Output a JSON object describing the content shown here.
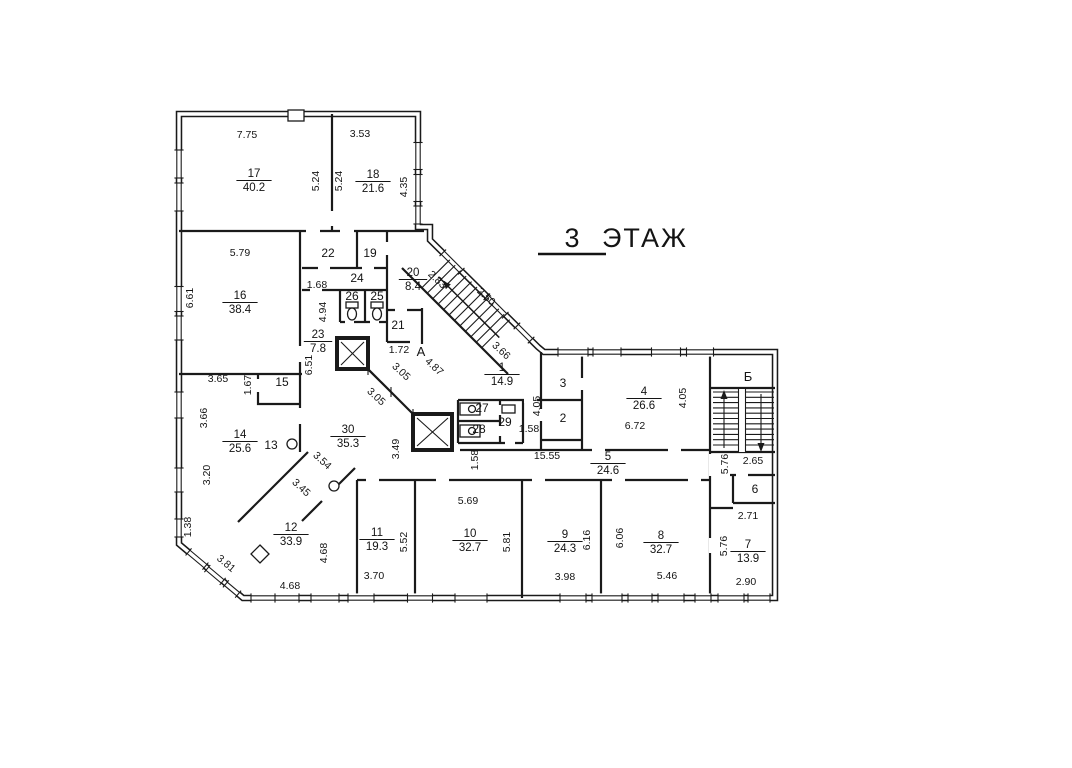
{
  "title": {
    "number": "3",
    "word": "ЭТАЖ"
  },
  "colors": {
    "ink": "#1a1a1a",
    "paper": "#ffffff"
  },
  "stairwells": [
    {
      "label": "А",
      "x": 421,
      "y": 356
    },
    {
      "label": "Б",
      "x": 748,
      "y": 381
    }
  ],
  "rooms": [
    {
      "number": "17",
      "area": "40.2",
      "x": 254,
      "y": 180
    },
    {
      "number": "18",
      "area": "21.6",
      "x": 373,
      "y": 181
    },
    {
      "number": "16",
      "area": "38.4",
      "x": 240,
      "y": 302
    },
    {
      "number": "20",
      "area": "8.4",
      "x": 413,
      "y": 279
    },
    {
      "number": "23",
      "area": "7.8",
      "x": 318,
      "y": 341
    },
    {
      "number": "1",
      "area": "14.9",
      "x": 502,
      "y": 374
    },
    {
      "number": "4",
      "area": "26.6",
      "x": 644,
      "y": 398
    },
    {
      "number": "14",
      "area": "25.6",
      "x": 240,
      "y": 441
    },
    {
      "number": "30",
      "area": "35.3",
      "x": 348,
      "y": 436
    },
    {
      "number": "5",
      "area": "24.6",
      "x": 608,
      "y": 463
    },
    {
      "number": "12",
      "area": "33.9",
      "x": 291,
      "y": 534
    },
    {
      "number": "11",
      "area": "19.3",
      "x": 377,
      "y": 539
    },
    {
      "number": "10",
      "area": "32.7",
      "x": 470,
      "y": 540
    },
    {
      "number": "9",
      "area": "24.3",
      "x": 565,
      "y": 541
    },
    {
      "number": "8",
      "area": "32.7",
      "x": 661,
      "y": 542
    },
    {
      "number": "7",
      "area": "13.9",
      "x": 748,
      "y": 551
    }
  ],
  "numbered_spaces": [
    {
      "label": "22",
      "x": 328,
      "y": 257
    },
    {
      "label": "19",
      "x": 370,
      "y": 257
    },
    {
      "label": "24",
      "x": 357,
      "y": 282
    },
    {
      "label": "26",
      "x": 352,
      "y": 300
    },
    {
      "label": "25",
      "x": 377,
      "y": 300
    },
    {
      "label": "21",
      "x": 398,
      "y": 329
    },
    {
      "label": "15",
      "x": 282,
      "y": 386
    },
    {
      "label": "13",
      "x": 271,
      "y": 449
    },
    {
      "label": "3",
      "x": 563,
      "y": 387
    },
    {
      "label": "2",
      "x": 563,
      "y": 422
    },
    {
      "label": "27",
      "x": 482,
      "y": 412
    },
    {
      "label": "28",
      "x": 479,
      "y": 433
    },
    {
      "label": "29",
      "x": 505,
      "y": 426
    },
    {
      "label": "6",
      "x": 755,
      "y": 493
    }
  ],
  "dimensions": [
    {
      "t": "7.75",
      "x": 247,
      "y": 138,
      "r": 0
    },
    {
      "t": "3.53",
      "x": 360,
      "y": 137,
      "r": 0
    },
    {
      "t": "5.24",
      "x": 319,
      "y": 181,
      "r": -90
    },
    {
      "t": "5.24",
      "x": 342,
      "y": 181,
      "r": -90
    },
    {
      "t": "4.35",
      "x": 407,
      "y": 187,
      "r": -90
    },
    {
      "t": "5.79",
      "x": 240,
      "y": 256,
      "r": 0
    },
    {
      "t": "6.61",
      "x": 193,
      "y": 298,
      "r": -90
    },
    {
      "t": "1.68",
      "x": 317,
      "y": 288,
      "r": 0
    },
    {
      "t": "4.94",
      "x": 326,
      "y": 312,
      "r": -90
    },
    {
      "t": "6.51",
      "x": 312,
      "y": 365,
      "r": -90
    },
    {
      "t": "3.65",
      "x": 218,
      "y": 382,
      "r": 0
    },
    {
      "t": "1.67",
      "x": 251,
      "y": 385,
      "r": -90
    },
    {
      "t": "3.66",
      "x": 207,
      "y": 418,
      "r": -90
    },
    {
      "t": "3.20",
      "x": 210,
      "y": 475,
      "r": -90
    },
    {
      "t": "1.38",
      "x": 191,
      "y": 527,
      "r": -90
    },
    {
      "t": "3.81",
      "x": 224,
      "y": 566,
      "r": 40
    },
    {
      "t": "4.68",
      "x": 327,
      "y": 553,
      "r": -90
    },
    {
      "t": "4.68",
      "x": 290,
      "y": 589,
      "r": 0
    },
    {
      "t": "3.70",
      "x": 374,
      "y": 579,
      "r": 0
    },
    {
      "t": "5.52",
      "x": 407,
      "y": 542,
      "r": -90
    },
    {
      "t": "5.69",
      "x": 468,
      "y": 504,
      "r": 0
    },
    {
      "t": "5.81",
      "x": 510,
      "y": 542,
      "r": -90
    },
    {
      "t": "3.98",
      "x": 565,
      "y": 580,
      "r": 0
    },
    {
      "t": "6.16",
      "x": 590,
      "y": 540,
      "r": -90
    },
    {
      "t": "6.06",
      "x": 623,
      "y": 538,
      "r": -90
    },
    {
      "t": "5.46",
      "x": 667,
      "y": 579,
      "r": 0
    },
    {
      "t": "2.90",
      "x": 746,
      "y": 585,
      "r": 0
    },
    {
      "t": "5.76",
      "x": 727,
      "y": 546,
      "r": -90
    },
    {
      "t": "2.71",
      "x": 748,
      "y": 519,
      "r": 0
    },
    {
      "t": "2.65",
      "x": 753,
      "y": 464,
      "r": 0
    },
    {
      "t": "5.76",
      "x": 728,
      "y": 464,
      "r": -90
    },
    {
      "t": "6.72",
      "x": 635,
      "y": 429,
      "r": 0
    },
    {
      "t": "4.05",
      "x": 686,
      "y": 398,
      "r": -90
    },
    {
      "t": "4.05",
      "x": 540,
      "y": 406,
      "r": -90
    },
    {
      "t": "1.58",
      "x": 529,
      "y": 432,
      "r": 0
    },
    {
      "t": "1.58",
      "x": 478,
      "y": 460,
      "r": -90
    },
    {
      "t": "15.55",
      "x": 547,
      "y": 459,
      "r": 0
    },
    {
      "t": "3.49",
      "x": 399,
      "y": 449,
      "r": -90
    },
    {
      "t": "3.54",
      "x": 320,
      "y": 463,
      "r": 43
    },
    {
      "t": "3.45",
      "x": 299,
      "y": 490,
      "r": 43
    },
    {
      "t": "3.05",
      "x": 399,
      "y": 374,
      "r": 43
    },
    {
      "t": "3.05",
      "x": 374,
      "y": 399,
      "r": 43
    },
    {
      "t": "1.72",
      "x": 399,
      "y": 353,
      "r": 0
    },
    {
      "t": "4.87",
      "x": 432,
      "y": 369,
      "r": 43
    },
    {
      "t": "2.83",
      "x": 435,
      "y": 282,
      "r": 43
    },
    {
      "t": "2.50",
      "x": 484,
      "y": 299,
      "r": 43
    },
    {
      "t": "3.66",
      "x": 499,
      "y": 353,
      "r": 43
    }
  ]
}
